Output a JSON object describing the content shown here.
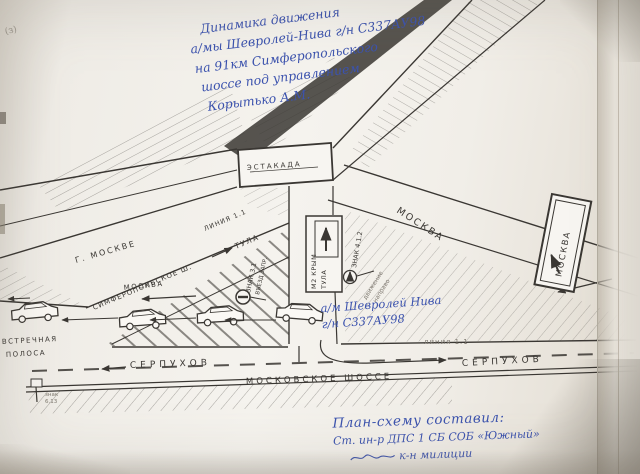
{
  "photo": {
    "corner_mark": "(з)"
  },
  "title_note": {
    "lines": [
      "Динамика движения",
      "а/мы Шевролей-Нива г/н С337АУ98",
      "на 91км Симферопольского",
      "шоссе под управлением",
      "Корытько А.М."
    ]
  },
  "car_note": {
    "line1": "а/м Шевролей Нива",
    "line2": "г/н С337АУ98"
  },
  "footer_note": {
    "lines": [
      "План-схему составил:",
      "Ст. ин-р ДПС 1 СБ СОБ «Южный»",
      "к-н милиции"
    ]
  },
  "roads": {
    "overpass": "эстакада",
    "moscow_upper": "Москва",
    "to_moscow": "г. Москве",
    "moscow_lane": "москва",
    "simferopol": "Симферопольское ш.",
    "tula": "Тула",
    "line_11_upper": "линия 1.1",
    "line_11_lower": "линия 1.1",
    "serpukhov_left": "Серпухов",
    "serpukhov_right": "Серпухов",
    "moscow_highway": "Московское шоссе",
    "oncoming_1": "встречная",
    "oncoming_2": "полоса"
  },
  "signs": {
    "moscow_board": "Москва",
    "m2_line1": "М2 Крым",
    "m2_line2": "Тула",
    "sign_31_l1": "знак 3.1",
    "sign_31_l2": "въезд запр.",
    "sign_412": "знак 4.1.2",
    "sign_412_sub1": "движение",
    "sign_412_sub2": "направо",
    "km_post_l1": "знак",
    "km_post_l2": "6.13"
  },
  "colors": {
    "ink_blue": "#3c53ae",
    "line_black": "#3a3733",
    "pencil": "#7d786f"
  }
}
